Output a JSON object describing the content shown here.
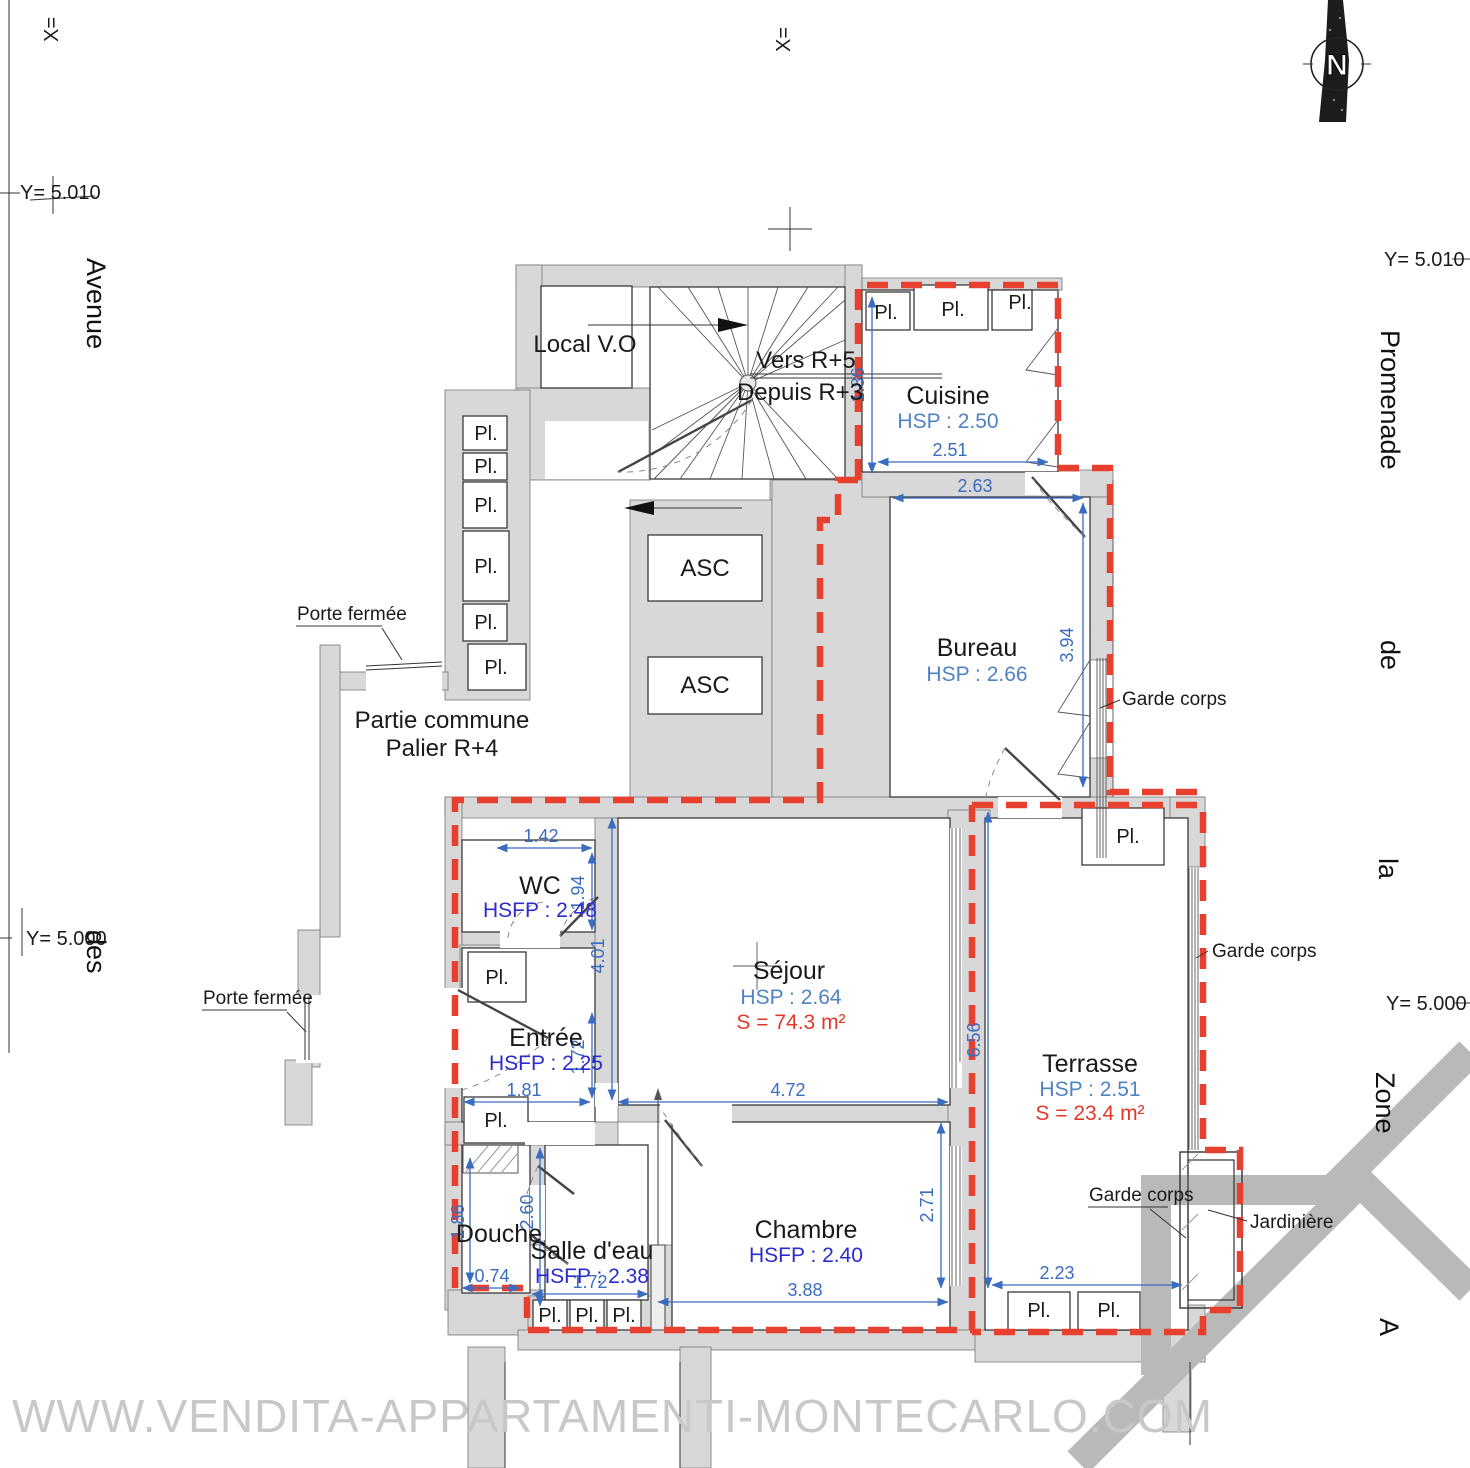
{
  "labels": {
    "local_vo": "Local V.O",
    "vers_r5": "Vers R+5",
    "depuis_r3": "Depuis R+3",
    "asc": "ASC",
    "partie_commune": "Partie commune",
    "palier": "Palier R+4",
    "porte_fermee": "Porte fermée",
    "pl": "Pl.",
    "garde_corps": "Garde corps",
    "jardiniere": "Jardinière",
    "north": "N",
    "watermark": "WWW.VENDITA-APPARTAMENTI-MONTECARLO.COM"
  },
  "axes": {
    "x_eq": "X=",
    "y_5010": "Y= 5.010",
    "y_5000": "Y= 5.000"
  },
  "streets": {
    "avenue": "Avenue",
    "des": "des",
    "promenade": "Promenade",
    "de": "de",
    "la": "la",
    "zone": "Zone",
    "a": "A"
  },
  "rooms": {
    "cuisine": {
      "name": "Cuisine",
      "height": "HSP : 2.50"
    },
    "bureau": {
      "name": "Bureau",
      "height": "HSP : 2.66"
    },
    "wc": {
      "name": "WC",
      "height": "HSFP : 2.48"
    },
    "entree": {
      "name": "Entrée",
      "height": "HSFP : 2.25"
    },
    "sejour": {
      "name": "Séjour",
      "height": "HSP : 2.64",
      "area": "S = 74.3 m²"
    },
    "douche": {
      "name": "Douche"
    },
    "salle_deau": {
      "name": "Salle d'eau",
      "height": "HSFP : 2.38"
    },
    "chambre": {
      "name": "Chambre",
      "height": "HSFP : 2.40"
    },
    "terrasse": {
      "name": "Terrasse",
      "height": "HSP : 2.51",
      "area": "S = 23.4 m²"
    }
  },
  "dims": {
    "cuisine_h": "1.86",
    "cuisine_w": "2.51",
    "bureau_w": "2.63",
    "bureau_h": "3.94",
    "wc_w": "1.42",
    "wc_h": "1.94",
    "hall_h": "4.01",
    "entree_h": "1.72",
    "entree_w": "1.81",
    "sejour_w": "4.72",
    "douche_h": "1.86",
    "douche_w": "0.74",
    "sde_h": "2.60",
    "sde_w": "1.72",
    "chambre_w": "3.88",
    "chambre_h": "2.71",
    "terrasse_h": "6.56",
    "terrasse_w": "2.23"
  },
  "colors": {
    "boundary_red": "#e8402e",
    "dimension_blue": "#3a6cc0",
    "hsfp_blue": "#2b2bd0",
    "hsp_blue": "#4f83c4",
    "area_red": "#e0392b",
    "wall_gray": "#d8d8d8",
    "watermark_gray": "#c8c8c8"
  }
}
